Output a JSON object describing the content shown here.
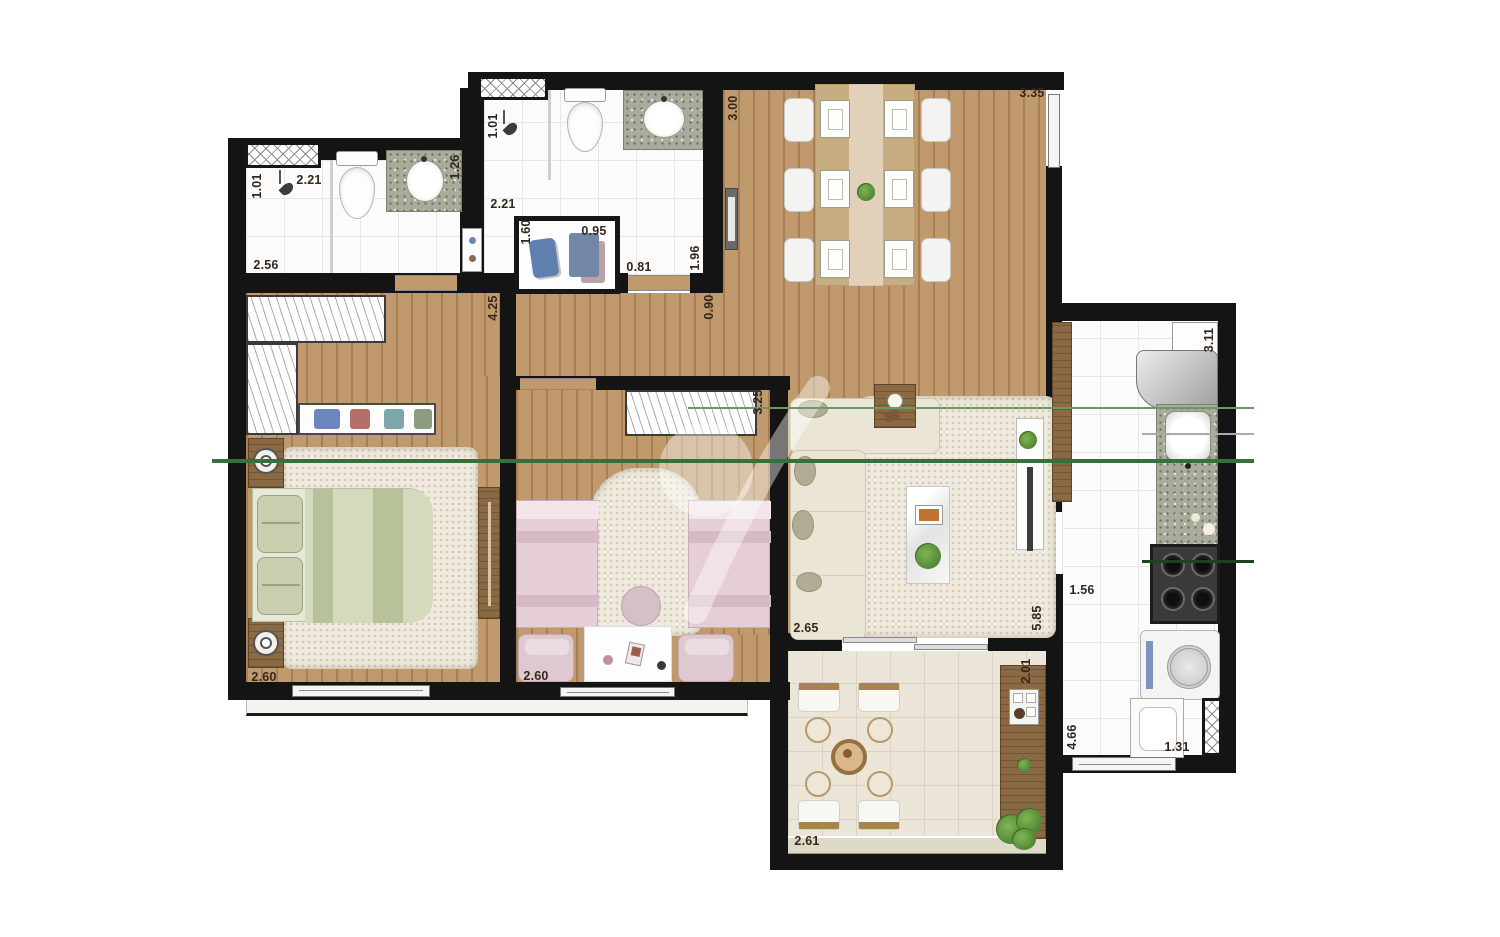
{
  "plan": {
    "type": "apartment-floor-plan",
    "dims": {
      "bath1_shower_width": "1.01",
      "bath1_shower_length": "2.21",
      "bath1_length": "2.56",
      "bath1_vanity": "1.26",
      "bath2_shower_width": "1.01",
      "bath2_shower_length": "2.21",
      "wardrobe_length": "1.60",
      "wardrobe_width": "0.95",
      "bath2_width": "0.81",
      "bath2_length": "1.96",
      "hall_width": "0.90",
      "dining_width": "3.00",
      "dining_length": "3.35",
      "kitchen_width": "3.11",
      "master_length": "4.25",
      "master_width": "2.60",
      "kids_length": "3.25",
      "kids_width": "2.60",
      "living_width": "2.65",
      "living_length": "5.85",
      "kitchen_counter": "1.56",
      "kitchen_length": "4.66",
      "kitchen_door": "1.31",
      "balcony_depth": "2.01",
      "balcony_width": "2.61"
    },
    "colors": {
      "wall": "#141414",
      "wood_floor": "#c09a6c",
      "annotation_green": "#3a6e3c",
      "annotation_green_light": "#6a9968",
      "label_text": "#34271a",
      "sage_bed": "#d4dabc",
      "pink_bed": "#e5ced7"
    }
  }
}
